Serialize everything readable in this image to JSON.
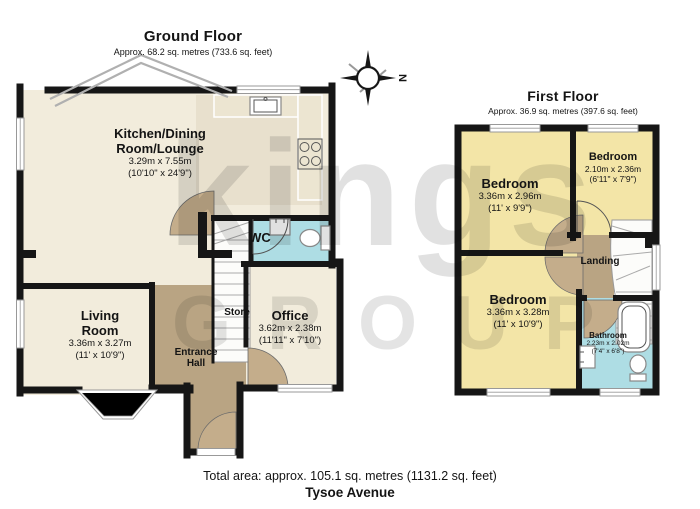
{
  "ground_floor": {
    "title": "Ground Floor",
    "subtitle": "Approx. 68.2 sq. metres (733.6 sq. feet)",
    "rooms": {
      "kitchen": {
        "name1": "Kitchen/Dining",
        "name2": "Room/Lounge",
        "metric": "3.29m x 7.55m",
        "imperial": "(10'10\" x 24'9\")"
      },
      "living": {
        "name1": "Living",
        "name2": "Room",
        "metric": "3.36m x 3.27m",
        "imperial": "(11' x 10'9\")"
      },
      "office": {
        "name": "Office",
        "metric": "3.62m x 2.38m",
        "imperial": "(11'11\" x 7'10\")"
      },
      "wc": {
        "name": "WC"
      },
      "store": {
        "name": "Store"
      },
      "hall": {
        "name1": "Entrance",
        "name2": "Hall"
      }
    }
  },
  "first_floor": {
    "title": "First Floor",
    "subtitle": "Approx. 36.9 sq. metres (397.6 sq. feet)",
    "rooms": {
      "bedroom1": {
        "name": "Bedroom",
        "metric": "3.36m x 2.96m",
        "imperial": "(11' x 9'9\")"
      },
      "bedroom2": {
        "name": "Bedroom",
        "metric": "2.10m x 2.36m",
        "imperial": "(6'11\" x 7'9\")"
      },
      "bedroom3": {
        "name": "Bedroom",
        "metric": "3.36m x 3.28m",
        "imperial": "(11' x 10'9\")"
      },
      "landing": {
        "name": "Landing"
      },
      "bathroom": {
        "name": "Bathroom",
        "metric": "2.23m x 2.02m",
        "imperial": "(7'4\" x 6'8\")"
      }
    }
  },
  "compass": {
    "label": "N"
  },
  "watermark": {
    "line1": "kings",
    "line2": "GROUP"
  },
  "footer": {
    "total_area": "Total area: approx. 105.1 sq. metres (1131.2 sq. feet)",
    "address": "Tysoe Avenue"
  },
  "colors": {
    "cream": "#f2ecdc",
    "kitchen_floor": "#e8e0cd",
    "counter": "#ece5d1",
    "hall": "#b9a483",
    "door_leaf": "#c4ad8b",
    "bedroom": "#f3e5a7",
    "bathroom": "#aedde4",
    "wall": "#161616"
  }
}
